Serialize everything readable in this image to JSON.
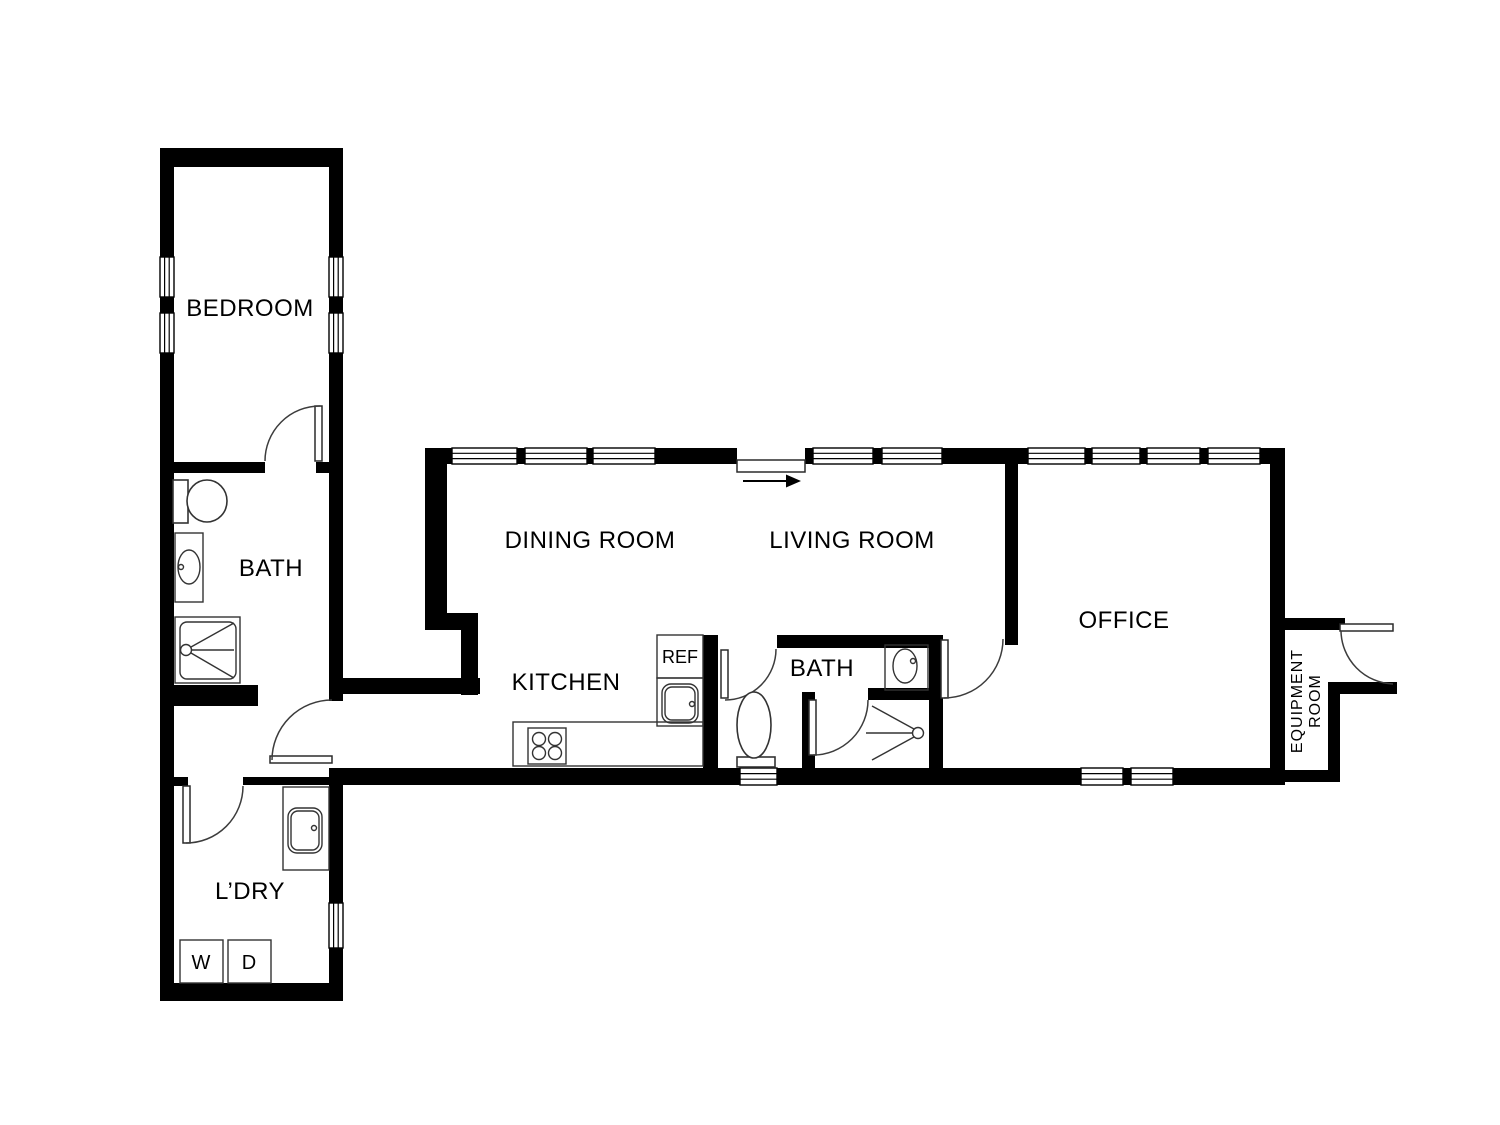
{
  "title": "Residential Floor Plan",
  "rooms": {
    "bedroom": {
      "label": "BEDROOM"
    },
    "bath_left": {
      "label": "BATH"
    },
    "laundry": {
      "label": "L’DRY"
    },
    "dining": {
      "label": "DINING ROOM"
    },
    "living": {
      "label": "LIVING ROOM"
    },
    "kitchen": {
      "label": "KITCHEN"
    },
    "bath_main": {
      "label": "BATH"
    },
    "office": {
      "label": "OFFICE"
    },
    "equipment": {
      "line1": "EQUIPMENT",
      "line2": "ROOM"
    }
  },
  "appliances": {
    "refrigerator": "REF",
    "washer": "W",
    "dryer": "D"
  },
  "colors": {
    "wall": "#000000",
    "background": "#ffffff",
    "fixture_stroke": "#333333",
    "door_arc": "#3c3c3c"
  }
}
